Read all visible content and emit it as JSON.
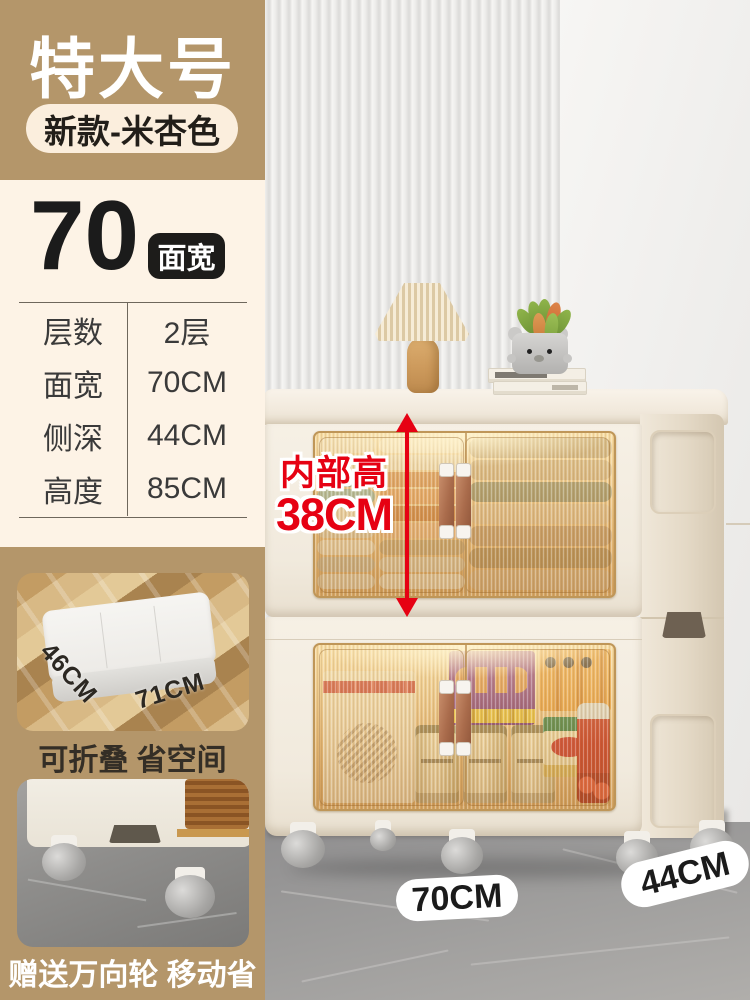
{
  "colors": {
    "tan_panel": "#b4966a",
    "cream_panel": "#fdf3e6",
    "badge_black": "#1d1c1a",
    "accent_red": "#e60113",
    "pill_cream": "#fbeedd",
    "cabinet_cream": "#f5efe4",
    "text_dark": "#3a3a3a"
  },
  "header": {
    "title": "特大号",
    "variant_badge": "新款-米杏色"
  },
  "spec": {
    "headline_number": "70",
    "headline_badge": "面宽",
    "rows": [
      {
        "label": "层数",
        "value": "2层"
      },
      {
        "label": "面宽",
        "value": "70CM"
      },
      {
        "label": "侧深",
        "value": "44CM"
      },
      {
        "label": "高度",
        "value": "85CM"
      }
    ]
  },
  "annotation": {
    "label": "内部高",
    "value": "38CM"
  },
  "insets": {
    "fold": {
      "dim_depth": "46CM",
      "dim_width": "71CM",
      "caption": "可折叠 省空间"
    },
    "wheels": {
      "caption": "赠送万向轮 移动省力"
    }
  },
  "floor_labels": {
    "width": "70CM",
    "depth": "44CM"
  }
}
